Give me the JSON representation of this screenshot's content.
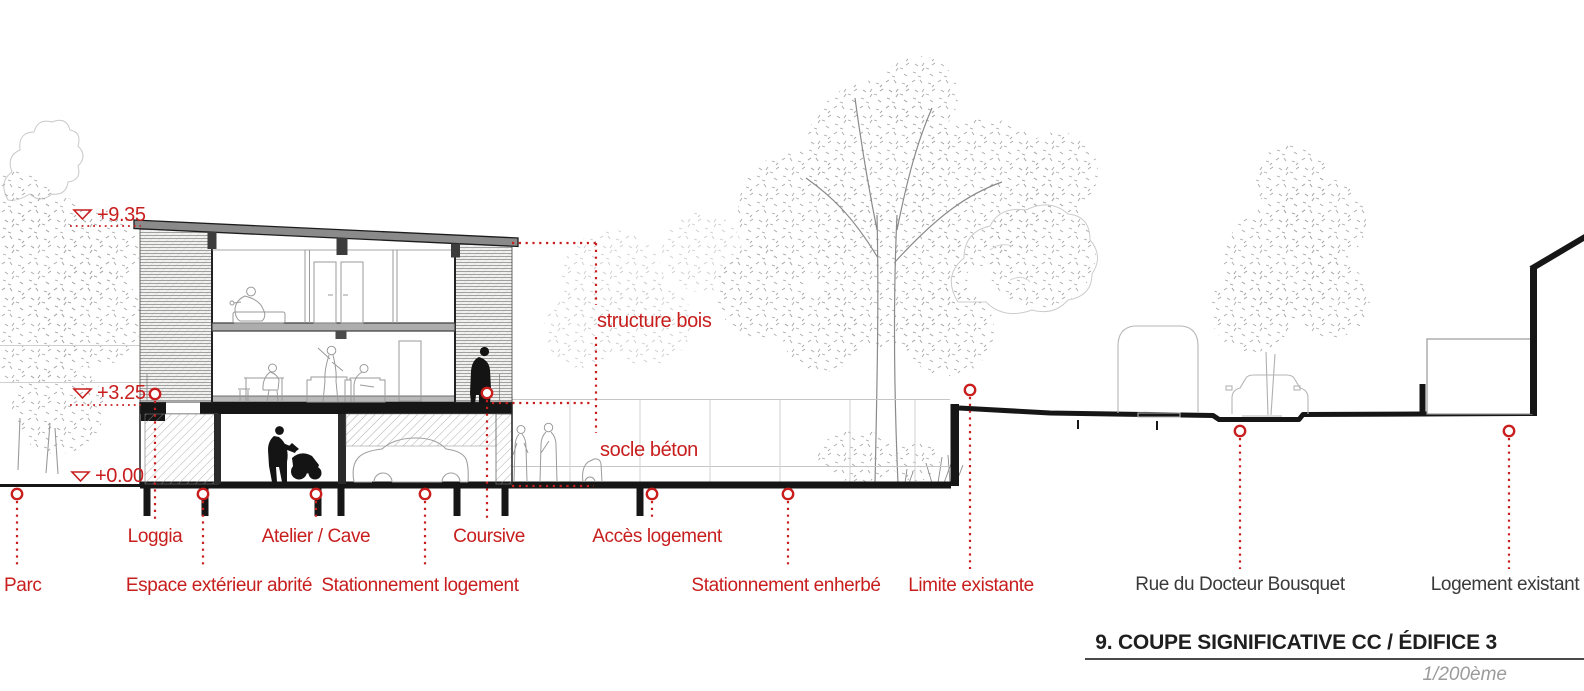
{
  "drawing": {
    "type": "architectural-section",
    "elevation_markers": {
      "roof": "+9.35",
      "first_floor": "+3.25",
      "ground": "+0.00"
    },
    "material_callouts": {
      "structure": "structure bois",
      "socle": "socle béton"
    },
    "callouts_row1": {
      "loggia": "Loggia",
      "atelier_cave": "Atelier / Cave",
      "coursive": "Coursive",
      "acces_logement": "Accès logement"
    },
    "callouts_row2": {
      "parc": "Parc",
      "espace_exterieur": "Espace extérieur abrité",
      "stationnement_logement": "Stationnement logement",
      "stationnement_enherbe": "Stationnement enherbé",
      "limite_existante": "Limite existante"
    },
    "context_labels": {
      "rue": "Rue du Docteur Bousquet",
      "logement_existant": "Logement existant"
    },
    "colors": {
      "annotation_red": "#c81e1e",
      "ink_black": "#161616",
      "context_label_gray": "#3a3a3a",
      "scale_gray": "#9b9b9b",
      "roof_gray": "#8a8a8a"
    }
  },
  "title_block": {
    "title": "9. COUPE SIGNIFICATIVE CC / ÉDIFICE 3",
    "scale": "1/200ème"
  }
}
